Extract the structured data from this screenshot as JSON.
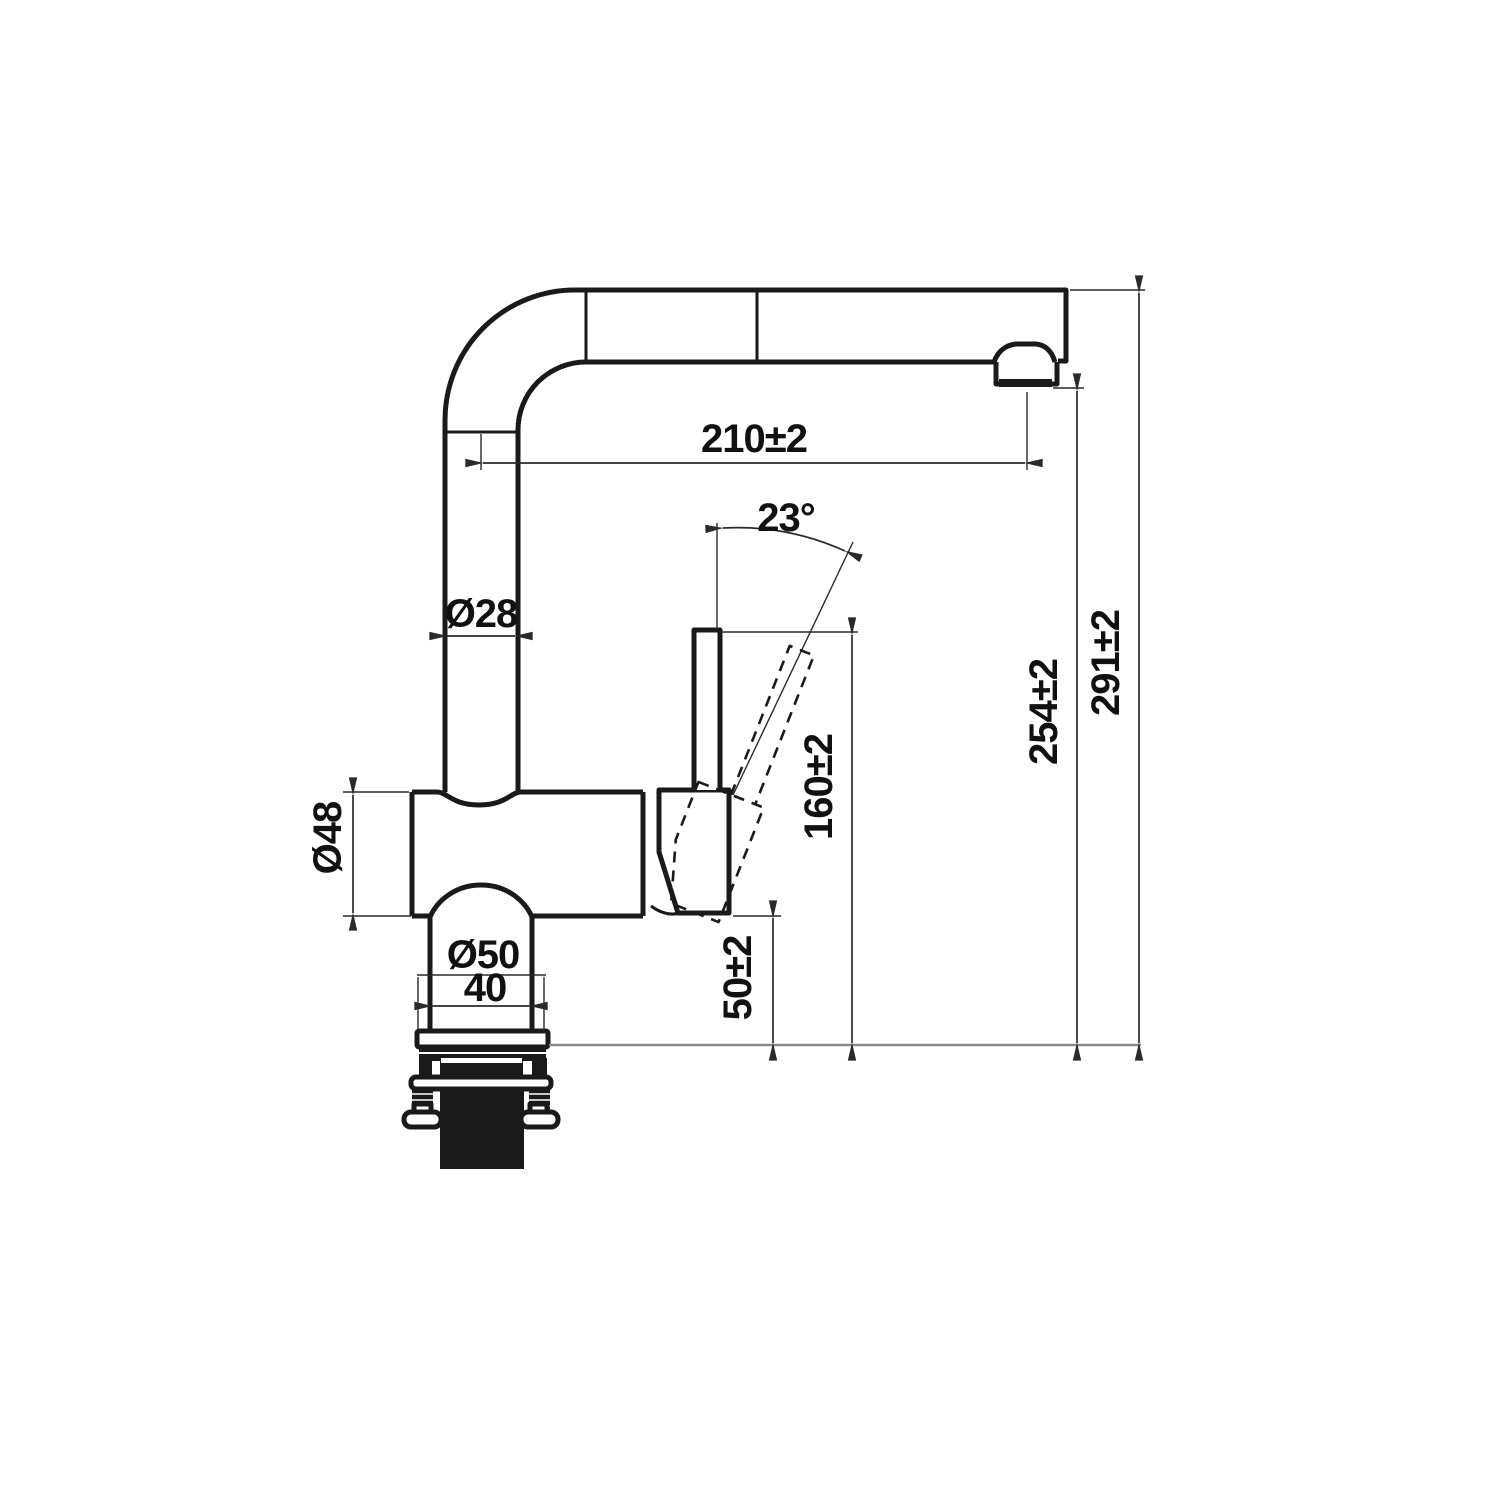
{
  "drawing": {
    "type": "faucet-installation-technical-drawing",
    "dimensions": {
      "spout_reach": "210±2",
      "handle_angle": "23°",
      "spout_pipe_diameter": "Ø28",
      "body_diameter": "Ø48",
      "base_flange_diameter": "Ø50",
      "base_width": "40",
      "base_height": "50±2",
      "handle_top_height": "160±2",
      "outlet_height": "254±2",
      "overall_height": "291±2"
    },
    "colors": {
      "object_line": "#1a1a1a",
      "dimension_line": "#2a2a2a",
      "reference_baseline": "#8a8a8a",
      "background": "#ffffff"
    }
  }
}
